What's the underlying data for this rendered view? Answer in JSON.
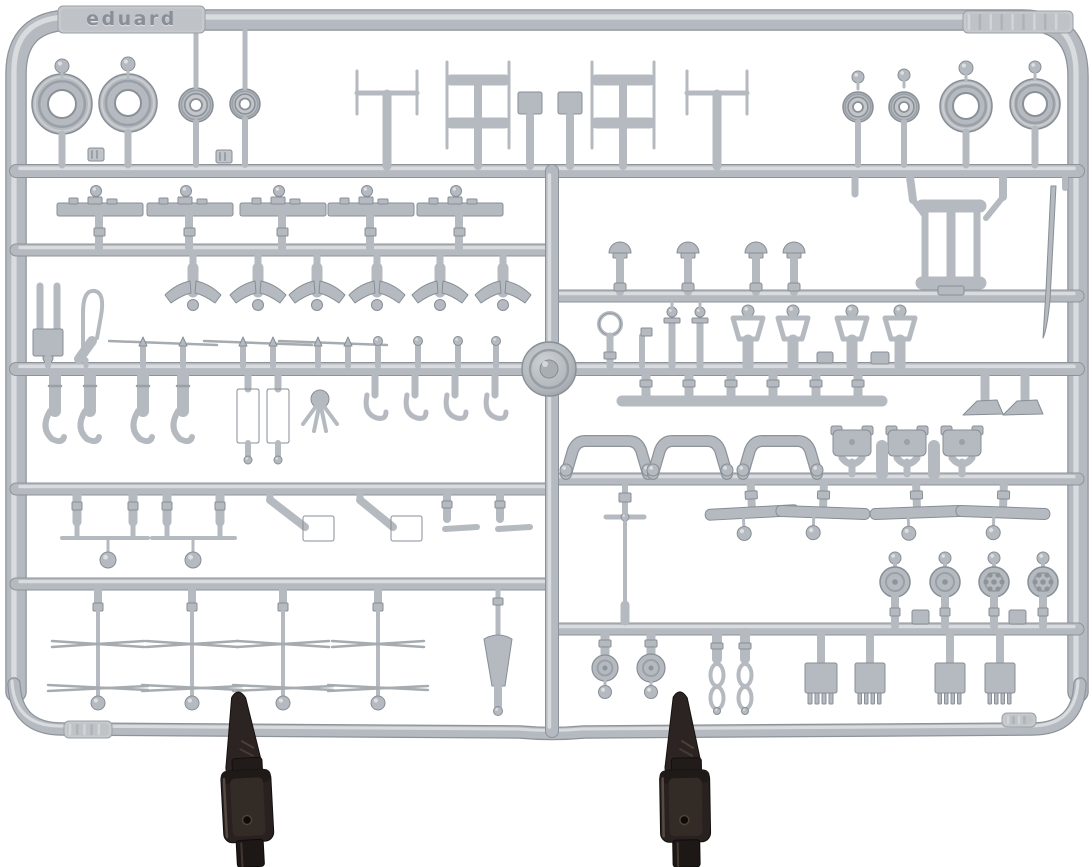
{
  "meta": {
    "description": "Grey injection-moulded plastic model kit sprue (parts tree) with wheels, struts, antennas and small detail parts, held upright by two black clip stands on a white background"
  },
  "palette": {
    "bg": "#ffffff",
    "plastic": "#b5bac0",
    "plastic_dark": "#8d939a",
    "plastic_line": "#878e95",
    "plastic_hi": "#d9dcde",
    "clip_dark": "#1d1816",
    "clip_body": "#282120",
    "clip_hi": "#564940"
  },
  "brand": {
    "label": "eduard"
  },
  "frame": {
    "outer": "M 16,692 L 16,74 Q 16,20 72,20 L 1022,20 Q 1078,20 1078,76 L 1078,692",
    "outer_w": 19,
    "bottom": "M 14,684 Q 16,729 62,729 L 520,732 Q 552,735 584,732 L 1032,729 Q 1078,729 1080,684",
    "bottom_w": 11
  },
  "rails": [
    [
      16,
      171,
      1078,
      171,
      12
    ],
    [
      16,
      250,
      552,
      250,
      11
    ],
    [
      552,
      296,
      1078,
      296,
      11
    ],
    [
      16,
      369,
      1078,
      369,
      12
    ],
    [
      16,
      489,
      552,
      489,
      11
    ],
    [
      552,
      479,
      1078,
      479,
      11
    ],
    [
      16,
      584,
      552,
      584,
      11
    ],
    [
      552,
      629,
      1078,
      629,
      11
    ],
    [
      552,
      171,
      552,
      731,
      12
    ]
  ],
  "hub": {
    "cx": 549,
    "cy": 369,
    "r": 27
  },
  "tabs": [
    {
      "x": 58,
      "y": 6,
      "w": 147,
      "h": 27,
      "text": "eduard"
    },
    {
      "x": 963,
      "y": 11,
      "w": 110,
      "h": 22,
      "ridges": 9
    },
    {
      "x": 64,
      "y": 721,
      "w": 48,
      "h": 17,
      "ridges": 5
    },
    {
      "x": 1002,
      "y": 713,
      "w": 34,
      "h": 14,
      "ridges": 4
    }
  ],
  "numberplates": [
    [
      88,
      148,
      16,
      13
    ],
    [
      216,
      150,
      16,
      13
    ]
  ],
  "parts": {
    "tire": [
      [
        62,
        104,
        30,
        14
      ],
      [
        128,
        103,
        29,
        13
      ],
      [
        966,
        106,
        26,
        13
      ],
      [
        1035,
        104,
        25,
        12
      ]
    ],
    "hubwheel": [
      [
        196,
        105,
        17,
        6
      ],
      [
        245,
        104,
        15,
        5.5
      ],
      [
        858,
        107,
        15,
        5
      ],
      [
        904,
        107,
        15,
        5
      ]
    ],
    "knob": [
      [
        62,
        66,
        7
      ],
      [
        128,
        64,
        7
      ],
      [
        858,
        77,
        6
      ],
      [
        904,
        75,
        6
      ],
      [
        966,
        68,
        7
      ],
      [
        1035,
        67,
        6
      ],
      [
        48,
        358,
        5
      ]
    ],
    "stem": [
      [
        62,
        134,
        62,
        165,
        7
      ],
      [
        128,
        132,
        128,
        165,
        7
      ],
      [
        196,
        28,
        196,
        87,
        5
      ],
      [
        196,
        122,
        196,
        165,
        6
      ],
      [
        245,
        28,
        245,
        88,
        5
      ],
      [
        245,
        119,
        245,
        165,
        6
      ],
      [
        858,
        122,
        858,
        165,
        6
      ],
      [
        904,
        122,
        904,
        165,
        6
      ],
      [
        966,
        132,
        966,
        165,
        7
      ],
      [
        1035,
        129,
        1035,
        165,
        7
      ],
      [
        855,
        176,
        855,
        194,
        7
      ],
      [
        1065,
        176,
        1065,
        188,
        6
      ]
    ],
    "mastT": [
      [
        387
      ],
      [
        717
      ]
    ],
    "mastH": [
      [
        478
      ],
      [
        623
      ]
    ],
    "mastP": [
      [
        530
      ],
      [
        570
      ]
    ],
    "panel": [
      [
        100
      ],
      [
        190
      ],
      [
        283
      ],
      [
        371
      ],
      [
        460
      ]
    ],
    "yoke": [
      [
        193
      ],
      [
        258
      ],
      [
        317
      ],
      [
        377
      ],
      [
        440
      ],
      [
        503
      ]
    ],
    "fork": [
      [
        47
      ]
    ],
    "wire": [
      [
        88
      ]
    ],
    "pitot": [
      [
        163,
        143,
        183
      ],
      [
        258,
        243,
        273
      ],
      [
        333,
        318,
        348
      ]
    ],
    "knobstem": [
      [
        378
      ],
      [
        418
      ],
      [
        458
      ],
      [
        496
      ]
    ],
    "claw": [
      [
        55
      ],
      [
        90
      ],
      [
        143
      ],
      [
        183
      ]
    ],
    "rectframe": [
      [
        248
      ],
      [
        278
      ]
    ],
    "spider": [
      [
        320
      ]
    ],
    "hookpin": [
      [
        375
      ],
      [
        415
      ],
      [
        455
      ],
      [
        495
      ]
    ],
    "mushroom": [
      [
        620
      ],
      [
        688
      ],
      [
        756
      ],
      [
        794
      ]
    ],
    "hframe": [
      [
        951
      ]
    ],
    "blade": [
      [
        1053
      ]
    ],
    "ringpart": [
      [
        610
      ]
    ],
    "flagpart": [
      [
        642
      ]
    ],
    "candle": [
      [
        672
      ],
      [
        700
      ]
    ],
    "hanger": [
      [
        748
      ],
      [
        793
      ],
      [
        852
      ],
      [
        900
      ]
    ],
    "block": [
      [
        817,
        352,
        16,
        11
      ],
      [
        871,
        352,
        18,
        12
      ],
      [
        912,
        610,
        17,
        14
      ],
      [
        1009,
        610,
        17,
        14
      ]
    ],
    "bracket": [
      [
        646
      ],
      [
        689
      ],
      [
        731
      ],
      [
        773
      ],
      [
        816
      ],
      [
        858
      ]
    ],
    "wedge": [
      [
        985
      ],
      [
        1025
      ]
    ],
    "bridge": [
      [
        607,
        37
      ],
      [
        690,
        33
      ],
      [
        780,
        33
      ]
    ],
    "head": [
      [
        852
      ],
      [
        907
      ],
      [
        962
      ]
    ],
    "post": [
      [
        882
      ],
      [
        934
      ]
    ],
    "proppin": [
      [
        625
      ]
    ],
    "barpin": [
      [
        752,
        -3
      ],
      [
        823,
        2
      ],
      [
        917,
        -2
      ],
      [
        1003,
        2
      ]
    ],
    "smallwheel": [
      [
        895,
        0
      ],
      [
        945,
        0
      ],
      [
        994,
        1
      ],
      [
        1043,
        1
      ]
    ],
    "disc": [
      [
        605,
        12
      ],
      [
        651,
        13
      ]
    ],
    "chain": [
      [
        717
      ],
      [
        745
      ]
    ],
    "grille": [
      [
        821,
        32
      ],
      [
        870,
        30
      ],
      [
        950,
        30
      ],
      [
        1000,
        30
      ]
    ],
    "antenna": [
      [
        98
      ],
      [
        192
      ],
      [
        283
      ],
      [
        378
      ]
    ],
    "funnel": [
      [
        498
      ]
    ],
    "pinpair": [
      [
        77,
        133,
        62,
        148,
        108
      ],
      [
        167,
        220,
        152,
        235,
        193
      ]
    ],
    "zstrut": [
      [
        270,
        305,
        303
      ],
      [
        360,
        393,
        391
      ]
    ],
    "tpin": [
      [
        447
      ],
      [
        500
      ]
    ]
  },
  "clips": [
    [
      247,
      -3
    ],
    [
      685,
      -1
    ]
  ]
}
